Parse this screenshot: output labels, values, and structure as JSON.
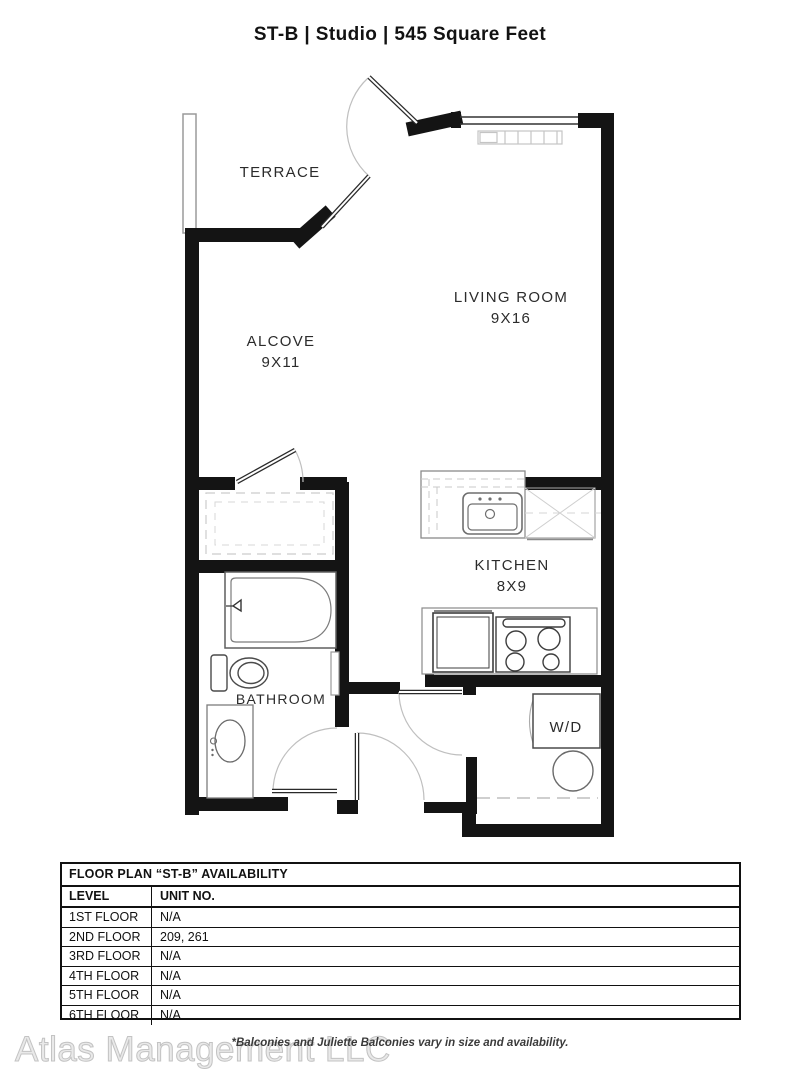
{
  "header": {
    "title": "ST-B | Studio | 545 Square Feet"
  },
  "floor_plan": {
    "rooms": {
      "terrace": {
        "label": "TERRACE"
      },
      "alcove": {
        "label": "ALCOVE",
        "dims": "9X11"
      },
      "living_room": {
        "label": "LIVING ROOM",
        "dims": "9X16"
      },
      "kitchen": {
        "label": "KITCHEN",
        "dims": "8X9"
      },
      "bathroom": {
        "label": "BATHROOM"
      },
      "laundry": {
        "label": "W/D"
      }
    },
    "colors": {
      "wall": "#141414",
      "fixture": "#555555",
      "faint": "#c9c9c9"
    }
  },
  "availability": {
    "title": "FLOOR PLAN “ST-B” AVAILABILITY",
    "columns": [
      "LEVEL",
      "UNIT NO."
    ],
    "rows": [
      {
        "level": "1ST FLOOR",
        "unit": "N/A"
      },
      {
        "level": "2ND FLOOR",
        "unit": "209, 261"
      },
      {
        "level": "3RD FLOOR",
        "unit": "N/A"
      },
      {
        "level": "4TH FLOOR",
        "unit": "N/A"
      },
      {
        "level": "5TH FLOOR",
        "unit": "N/A"
      },
      {
        "level": "6TH FLOOR",
        "unit": "N/A"
      }
    ]
  },
  "footer": {
    "watermark": "Atlas Management LLC",
    "disclaimer": "*Balconies and Juliette Balconies vary in size and availability."
  }
}
